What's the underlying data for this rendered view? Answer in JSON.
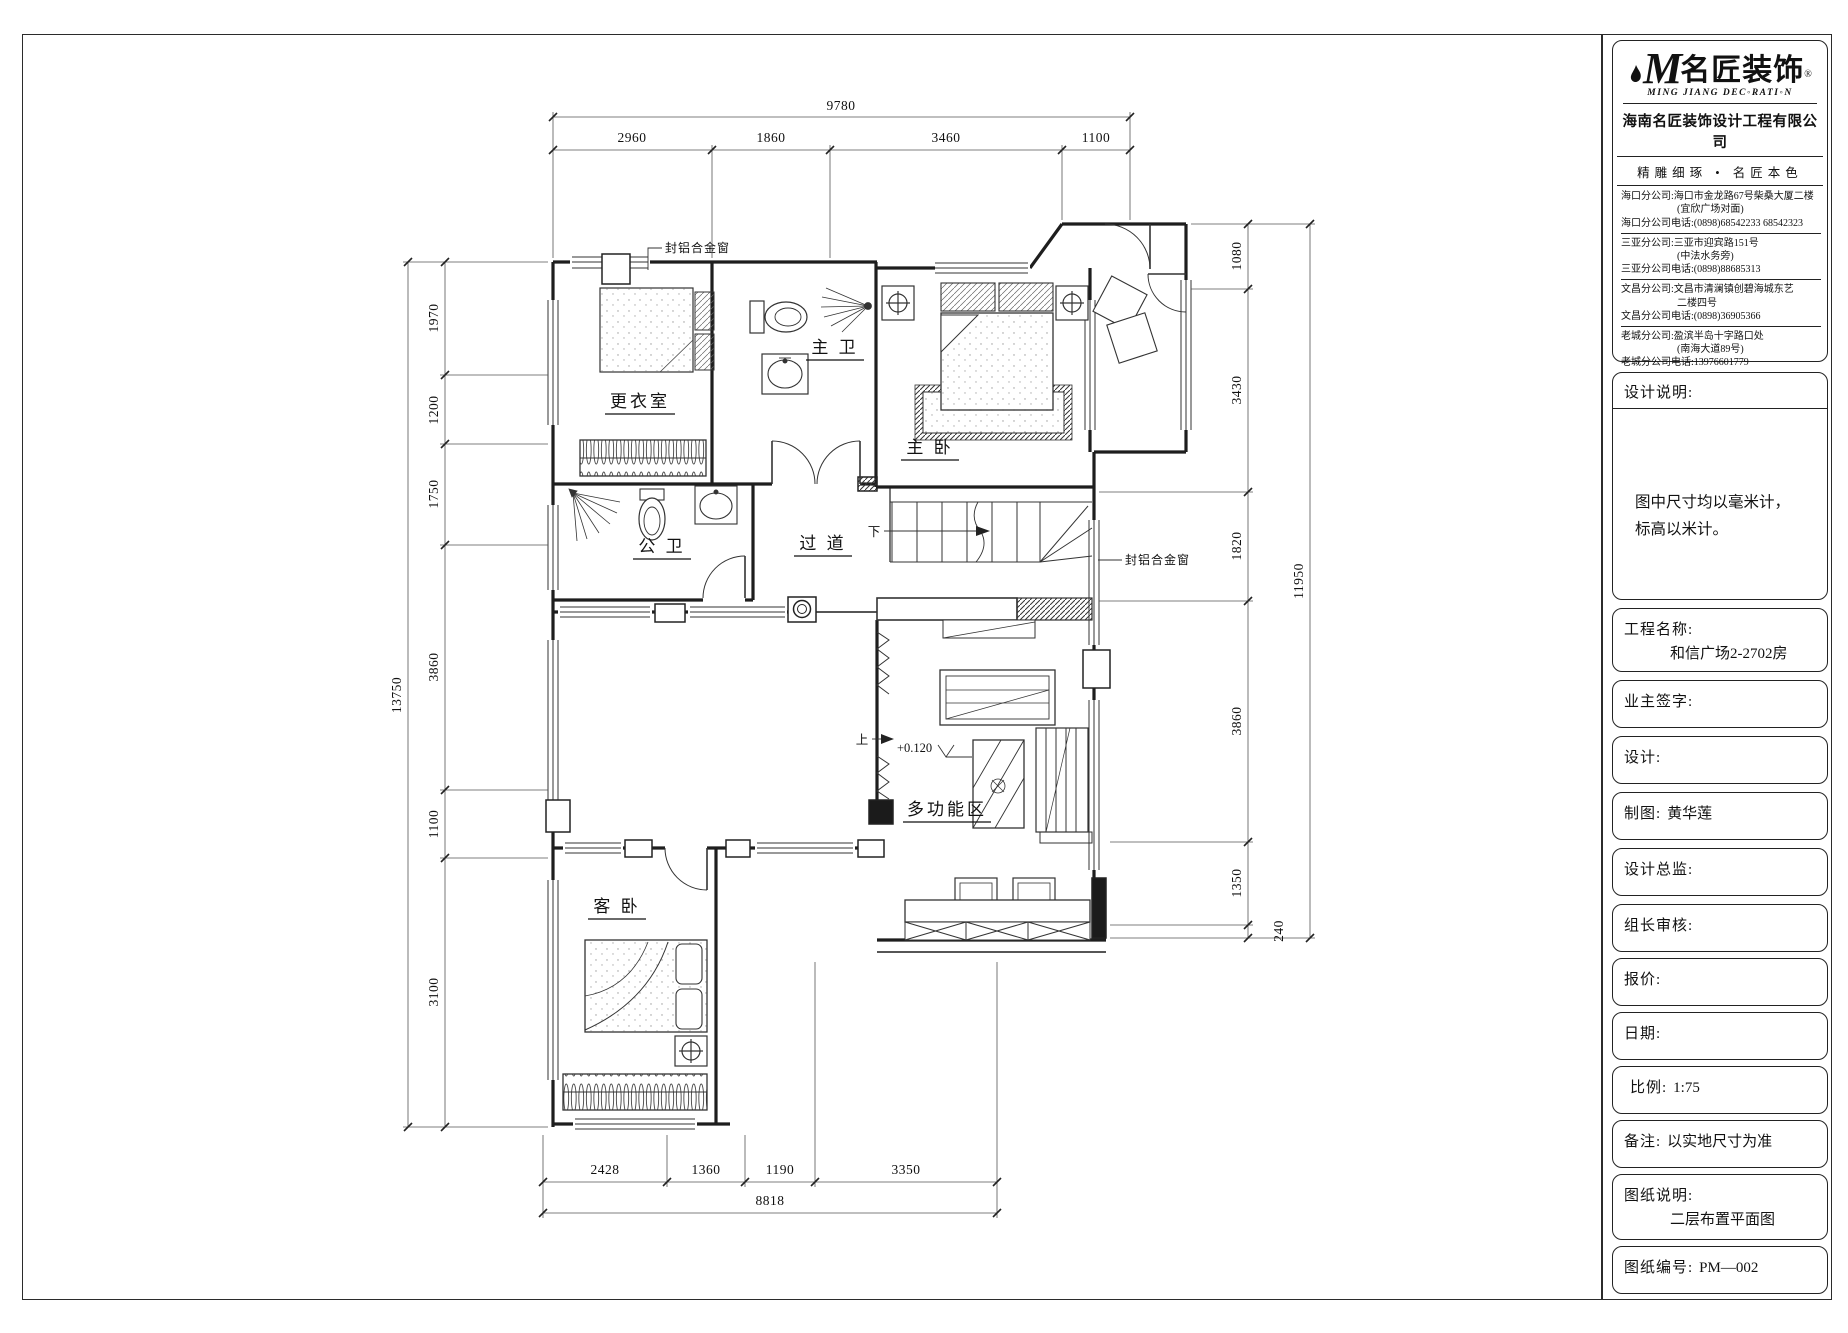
{
  "title_block": {
    "logo": {
      "m": "M",
      "cn": "名匠装饰",
      "reg": "®",
      "en": "MING JIANG DEC◦RATI◦N"
    },
    "company": "海南名匠装饰设计工程有限公司",
    "slogan": "精雕细琢 • 名匠本色",
    "branches": [
      {
        "t": "海口分公司:海口市金龙路67号柴桑大厦二楼"
      },
      {
        "t": "(宜欣广场对面)"
      },
      {
        "t": "海口分公司电话:(0898)68542233 68542323"
      },
      {
        "t": "三亚分公司:三亚市迎宾路151号"
      },
      {
        "t": "(中法水务旁)"
      },
      {
        "t": "三亚分公司电话:(0898)88685313"
      },
      {
        "t": "文昌分公司:文昌市清澜镇创碧海城东艺"
      },
      {
        "t": "二楼四号"
      },
      {
        "t": "文昌分公司电话:(0898)36905366"
      },
      {
        "t": "老城分公司:盈滨半岛十字路口处"
      },
      {
        "t": "(南海大道89号)"
      },
      {
        "t": "老城分公司电话:13976601779"
      }
    ],
    "design_note": {
      "label": "设计说明:",
      "line1": "图中尺寸均以毫米计，",
      "line2": "标高以米计。"
    },
    "fields": [
      {
        "label": "工程名称:",
        "value": "和信广场2-2702房"
      },
      {
        "label": "业主签字:",
        "value": ""
      },
      {
        "label": "设计:",
        "value": ""
      },
      {
        "label": "制图:",
        "value": "黄华莲"
      },
      {
        "label": "设计总监:",
        "value": ""
      },
      {
        "label": "组长审核:",
        "value": ""
      },
      {
        "label": "报价:",
        "value": ""
      },
      {
        "label": "日期:",
        "value": ""
      },
      {
        "label": "比例:",
        "value": "1:75"
      },
      {
        "label": "备注:",
        "value": "以实地尺寸为准"
      },
      {
        "label": "图纸说明:",
        "value": "二层布置平面图"
      },
      {
        "label": "图纸编号:",
        "value": "PM—002"
      }
    ]
  },
  "plan": {
    "rooms": {
      "dressing": "更衣室",
      "master_bath": "主 卫",
      "master_bed": "主 卧",
      "shared_bath": "公 卫",
      "corridor": "过 道",
      "guest_bed": "客 卧",
      "multi": "多功能区"
    },
    "annotations": {
      "alu_window": "封铝合金窗",
      "down": "下",
      "up": "上",
      "level": "+0.120"
    },
    "dims": {
      "top": {
        "overall": "9780",
        "segments": [
          "2960",
          "1860",
          "3460",
          "1100"
        ]
      },
      "bottom": {
        "overall": "8818",
        "segments": [
          "2428",
          "1360",
          "1190",
          "3350"
        ]
      },
      "left": {
        "overall": "13750",
        "segments": [
          "1970",
          "1200",
          "1750",
          "3860",
          "1100",
          "3100"
        ]
      },
      "right": {
        "overall": "11950",
        "segments": [
          "1080",
          "3430",
          "1820",
          "3860",
          "1350",
          "240"
        ]
      }
    }
  }
}
